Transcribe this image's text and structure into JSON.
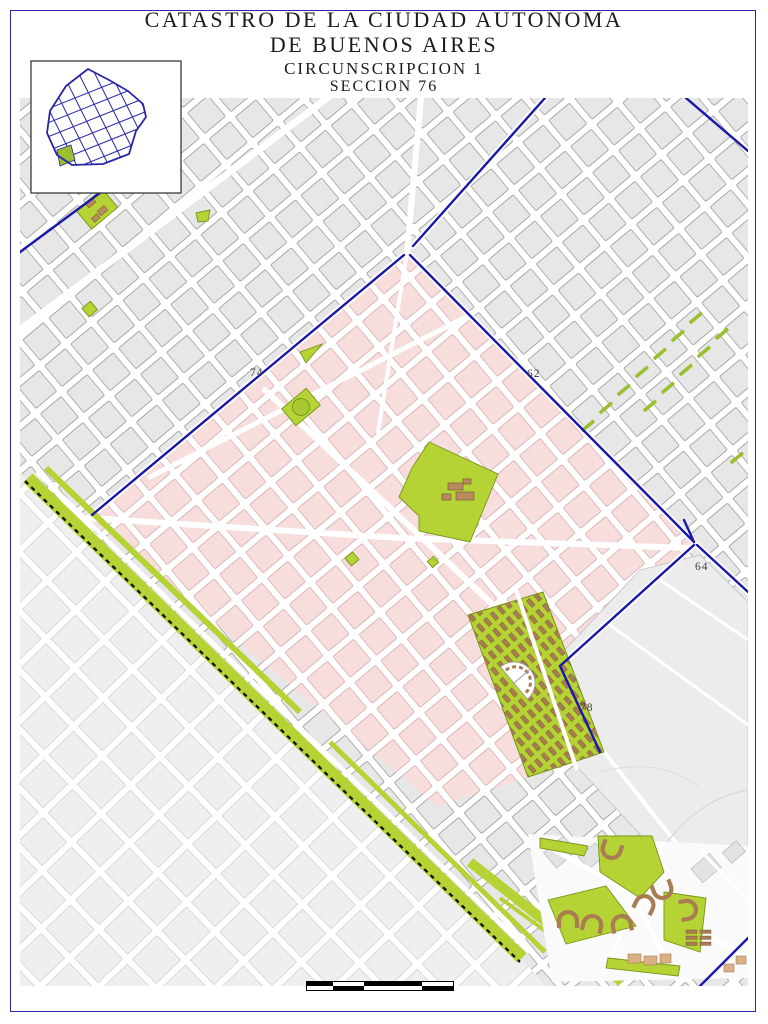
{
  "title": {
    "line1": "CATASTRO DE LA CIUDAD AUTONOMA",
    "line2": "DE BUENOS AIRES",
    "line3": "CIRCUNSCRIPCION 1",
    "line4": "SECCION 76"
  },
  "inset": {
    "description": "city-outline-locator",
    "outline_color": "#2626a8",
    "highlight_color": "#9bbf2e",
    "border_color": "#3a3a3a"
  },
  "map": {
    "section_labels": [
      {
        "text": "74"
      },
      {
        "text": "62"
      },
      {
        "text": "64"
      },
      {
        "text": "78"
      }
    ],
    "colors": {
      "section_fill": "#f8dddd",
      "section_block_stroke": "#d9b8b8",
      "neighbor_block": "#e7e7e7",
      "neighbor_block_stroke": "#a8a8a8",
      "faint_block": "#efefef",
      "open_area": "#ececec",
      "park_green": "#b5d334",
      "park_green_stroke": "#769617",
      "boundary_blue": "#1a18a8",
      "railway_black": "#111111",
      "building_brown": "#a97c52",
      "building_tan": "#d9b185",
      "street_white": "#ffffff"
    },
    "features": {
      "highlighted_section": "seccion-76",
      "cemetery": "cemetery-with-tomb-rows",
      "big_park": "large-park-with-buildings",
      "round_plaza": "plaza-with-circle",
      "railway": "railway-corridor-with-linear-park",
      "housing": "housing-complex-horseshoe-buildings",
      "median_strips": "green-avenue-medians"
    }
  },
  "scale_bar": {
    "segments": 4,
    "colors": [
      "#000000",
      "#ffffff"
    ]
  }
}
